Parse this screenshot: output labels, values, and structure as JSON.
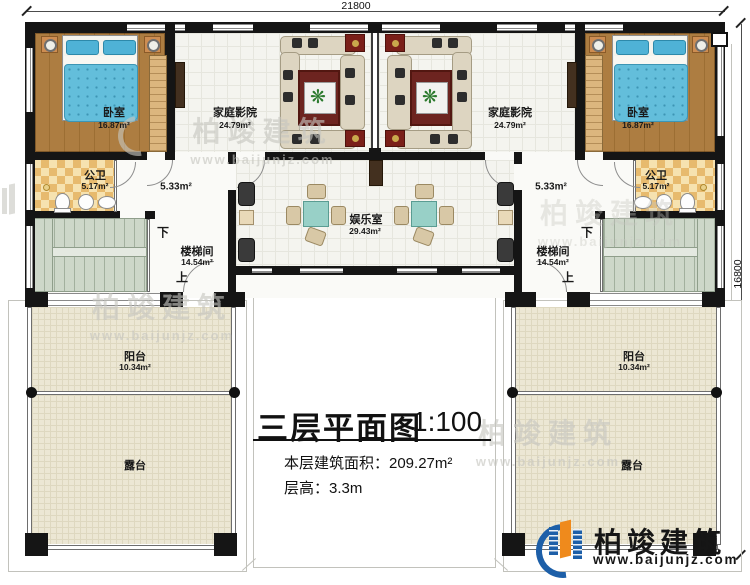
{
  "dimensions": {
    "width_mm": "21800",
    "height_mm": "16800"
  },
  "title_block": {
    "title": "三层平面图",
    "scale": "1:100",
    "floor_area": "本层建筑面积：209.27m²",
    "floor_height": "层高：3.3m"
  },
  "rooms": {
    "bedroom_left": {
      "name": "卧室",
      "area": "16.87m²"
    },
    "bedroom_right": {
      "name": "卧室",
      "area": "16.87m²"
    },
    "home_theater_left": {
      "name": "家庭影院",
      "area": "24.79m²"
    },
    "home_theater_right": {
      "name": "家庭影院",
      "area": "24.79m²"
    },
    "bathroom_left": {
      "name": "公卫",
      "area": "5.17m²"
    },
    "bathroom_right": {
      "name": "公卫",
      "area": "5.17m²"
    },
    "hallway_left": {
      "area": "5.33m²"
    },
    "hallway_right": {
      "area": "5.33m²"
    },
    "game_room": {
      "name": "娱乐室",
      "area": "29.43m²"
    },
    "stairwell_left": {
      "name": "楼梯间",
      "area": "14.54m²",
      "down_label": "下",
      "up_label": "上"
    },
    "stairwell_right": {
      "name": "楼梯间",
      "area": "14.54m²",
      "down_label": "下",
      "up_label": "上"
    },
    "balcony_left": {
      "name": "阳台",
      "area": "10.34m²"
    },
    "balcony_right": {
      "name": "阳台",
      "area": "10.34m²"
    },
    "terrace_left": {
      "name": "露台"
    },
    "terrace_right": {
      "name": "露台"
    }
  },
  "branding": {
    "company": "柏竣建筑",
    "website": "www.baijunjz.com"
  }
}
